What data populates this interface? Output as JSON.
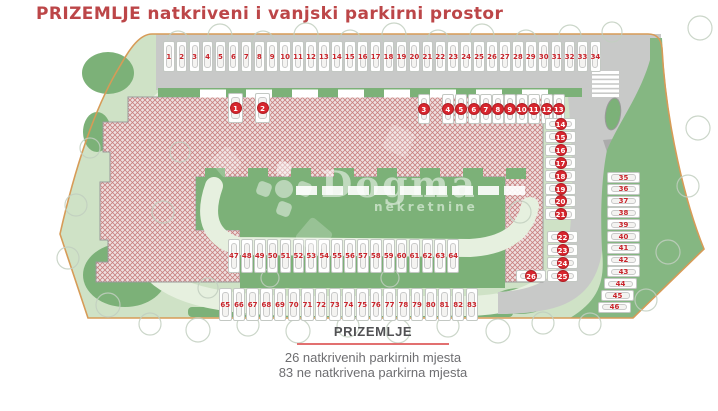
{
  "title": "PRIZEMLJE natkriveni i vanjski parkirni prostor",
  "legend": {
    "heading": "PRIZEMLJE",
    "line1": "26 natkrivenih parkirnih mjesta",
    "line2": "83 ne natkrivena parkirna mjesta"
  },
  "watermark": {
    "name": "Dogma",
    "subtitle": "nekretnine"
  },
  "colors": {
    "title_red": "#bc4648",
    "badge_red": "#d8262e",
    "stall_number_red": "#c8232a",
    "legend_divider_pink": "#e27070",
    "lawn_green": "#cfe2c6",
    "dark_green": "#7cb178",
    "road_gray": "#c8c9c8",
    "boundary_orange": "#d79b57",
    "building_hatch_red": "#c8807f"
  },
  "parking": {
    "covered": {
      "label": "natkriveni parkirni prostor",
      "count": 26,
      "groups": [
        {
          "id": "covered-left-pair",
          "numbers": [
            1,
            2
          ]
        },
        {
          "id": "covered-top-right",
          "numbers": [
            3,
            4,
            5,
            6,
            7,
            8,
            9,
            10,
            11,
            12,
            13
          ]
        },
        {
          "id": "covered-right-column",
          "numbers": [
            14,
            15,
            16,
            17,
            18,
            19,
            20,
            21
          ]
        },
        {
          "id": "covered-lower-column",
          "numbers": [
            22,
            23,
            24,
            25
          ]
        },
        {
          "id": "covered-single",
          "numbers": [
            26
          ]
        }
      ]
    },
    "uncovered": {
      "label": "vanjski parkirni prostor",
      "count": 83,
      "rows": [
        {
          "id": "top-row",
          "numbers": [
            1,
            2,
            3,
            4,
            5,
            6,
            7,
            8,
            9,
            10,
            11,
            12,
            13,
            14,
            15,
            16,
            17,
            18,
            19,
            20,
            21,
            22,
            23,
            24,
            25,
            26,
            27,
            28,
            29,
            30,
            31,
            32,
            33,
            34
          ]
        },
        {
          "id": "right-column",
          "numbers": [
            35,
            36,
            37,
            38,
            39,
            40,
            41,
            42,
            43,
            44,
            45,
            46
          ]
        },
        {
          "id": "middle-row",
          "numbers": [
            47,
            48,
            49,
            50,
            51,
            52,
            53,
            54,
            55,
            56,
            57,
            58,
            59,
            60,
            61,
            62,
            63,
            64
          ]
        },
        {
          "id": "bottom-row",
          "numbers": [
            65,
            66,
            67,
            68,
            69,
            70,
            71,
            72,
            73,
            74,
            75,
            76,
            77,
            78,
            79,
            80,
            81,
            82,
            83
          ]
        }
      ]
    }
  }
}
